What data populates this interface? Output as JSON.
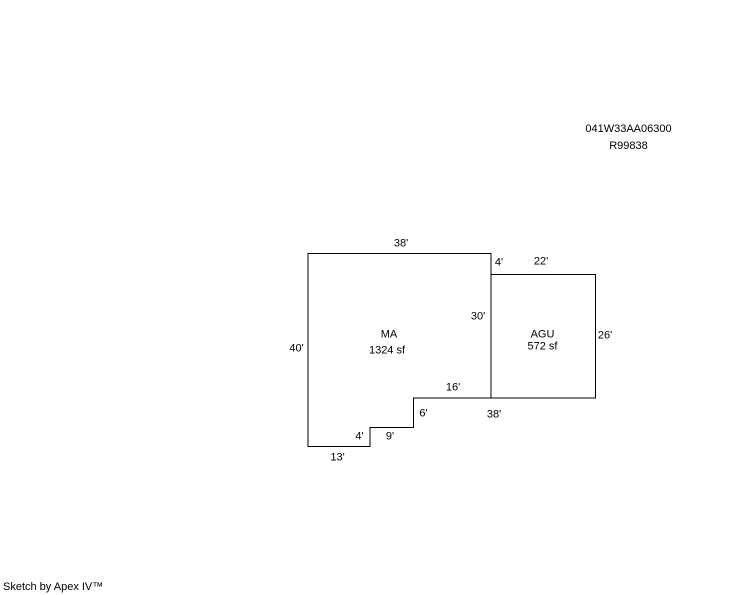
{
  "page": {
    "background_color": "#ffffff",
    "line_color": "#000000"
  },
  "header": {
    "parcel_number": "041W33AA06300",
    "record_number": "R99838"
  },
  "sketch": {
    "areas": [
      {
        "code": "MA",
        "size": "1324 sf",
        "code_x": 389,
        "code_y": 334.5,
        "size_x": 387,
        "size_y": 351
      },
      {
        "code": "AGU",
        "size": "572 sf",
        "code_x": 542.5,
        "code_y": 334.5,
        "size_x": 542.5,
        "size_y": 346.5
      }
    ],
    "dimension_labels": [
      {
        "text": "38'",
        "x": 401,
        "y": 243.5
      },
      {
        "text": "4'",
        "x": 499,
        "y": 262.5
      },
      {
        "text": "22'",
        "x": 541,
        "y": 261.5
      },
      {
        "text": "30'",
        "x": 478,
        "y": 317
      },
      {
        "text": "26'",
        "x": 605,
        "y": 336
      },
      {
        "text": "40'",
        "x": 296.5,
        "y": 349
      },
      {
        "text": "16'",
        "x": 453,
        "y": 387.5
      },
      {
        "text": "38'",
        "x": 494,
        "y": 414.5
      },
      {
        "text": "6'",
        "x": 423.5,
        "y": 414
      },
      {
        "text": "9'",
        "x": 390,
        "y": 437
      },
      {
        "text": "4'",
        "x": 359.5,
        "y": 436.5
      },
      {
        "text": "13'",
        "x": 337.5,
        "y": 458
      }
    ],
    "polygons": {
      "ma": [
        [
          308,
          253.5
        ],
        [
          491,
          253.5
        ],
        [
          491,
          398
        ],
        [
          413.5,
          398
        ],
        [
          413.5,
          427.5
        ],
        [
          370,
          427.5
        ],
        [
          370,
          446.5
        ],
        [
          308,
          446.5
        ]
      ],
      "agu": [
        [
          491,
          274.5
        ],
        [
          595.5,
          274.5
        ],
        [
          595.5,
          398
        ],
        [
          491,
          398
        ]
      ]
    }
  },
  "footer": {
    "credit": "Sketch by Apex IV™"
  }
}
